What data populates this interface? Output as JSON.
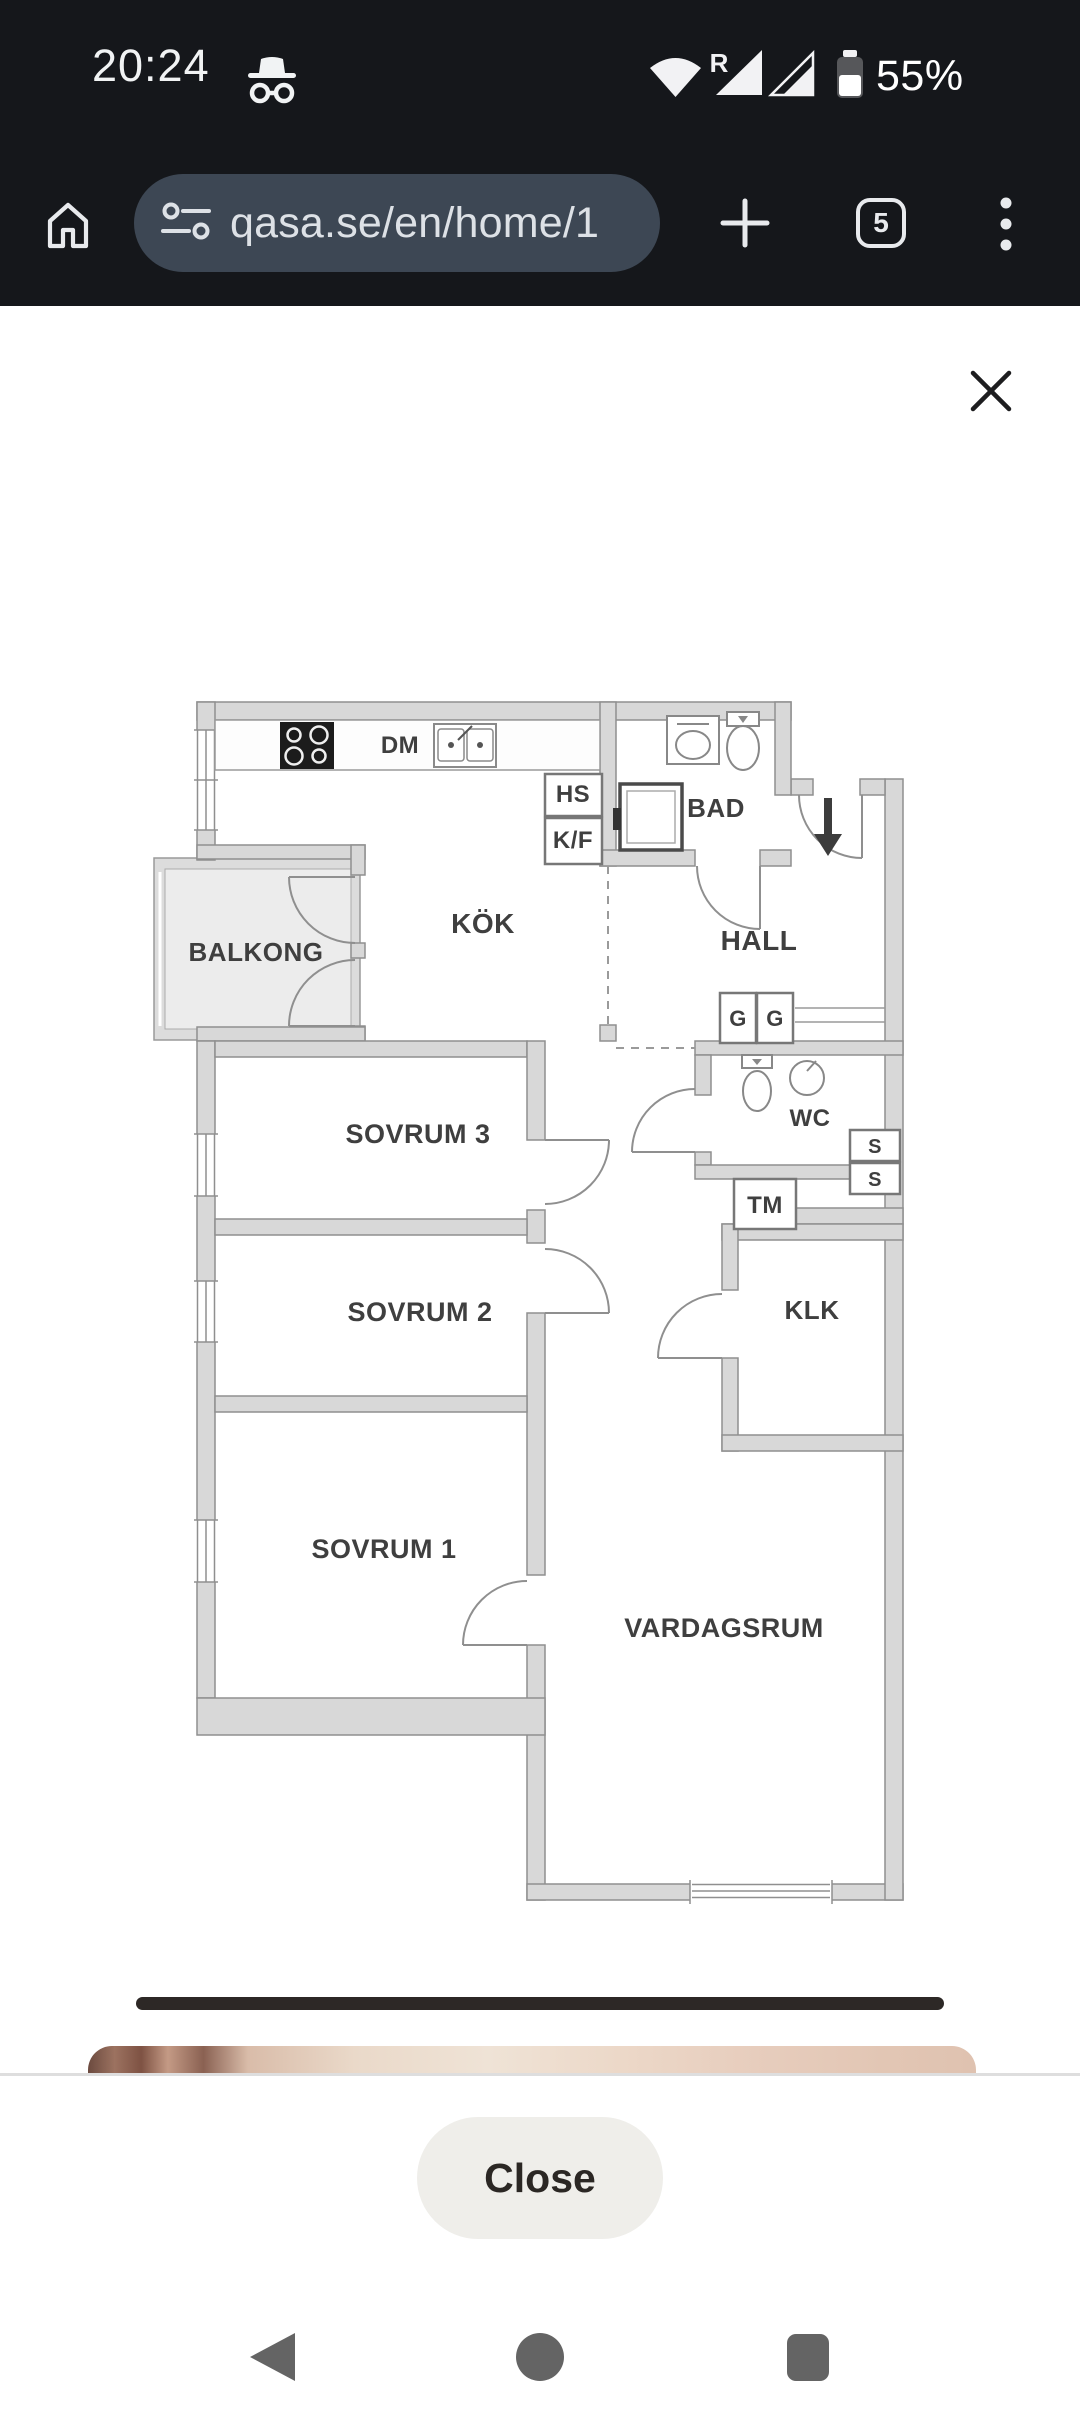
{
  "status_bar": {
    "time": "20:24",
    "incognito_icon": "incognito-icon",
    "wifi_icon": "wifi-icon",
    "network_type": "R",
    "signal_icons": [
      "cellular-signal-icon-1",
      "cellular-signal-icon-2"
    ],
    "battery_icon": "battery-icon",
    "battery_level": "55%"
  },
  "browser_bar": {
    "home_icon": "home-icon",
    "site_info_icon": "site-settings-icon",
    "url": "qasa.se/en/home/1",
    "new_tab_icon": "plus-icon",
    "tab_count": "5",
    "menu_icon": "three-dot-menu-icon"
  },
  "image_viewer": {
    "close_icon": "close-x-icon"
  },
  "floorplan": {
    "labels": [
      {
        "text": "DM",
        "x": 250,
        "y": 63,
        "size": 24
      },
      {
        "text": "HS",
        "x": 423,
        "y": 112,
        "size": 24
      },
      {
        "text": "K/F",
        "x": 423,
        "y": 158,
        "size": 24
      },
      {
        "text": "BAD",
        "x": 566,
        "y": 127,
        "size": 26
      },
      {
        "text": "KÖK",
        "x": 333,
        "y": 243,
        "size": 28
      },
      {
        "text": "HALL",
        "x": 609,
        "y": 260,
        "size": 28
      },
      {
        "text": "BALKONG",
        "x": 106,
        "y": 271,
        "size": 26
      },
      {
        "text": "G",
        "x": 588,
        "y": 336,
        "size": 22
      },
      {
        "text": "G",
        "x": 625,
        "y": 336,
        "size": 22
      },
      {
        "text": "WC",
        "x": 660,
        "y": 436,
        "size": 24
      },
      {
        "text": "SOVRUM 3",
        "x": 268,
        "y": 453,
        "size": 27
      },
      {
        "text": "S",
        "x": 725,
        "y": 463,
        "size": 20
      },
      {
        "text": "S",
        "x": 725,
        "y": 496,
        "size": 20
      },
      {
        "text": "TM",
        "x": 615,
        "y": 523,
        "size": 24
      },
      {
        "text": "SOVRUM 2",
        "x": 270,
        "y": 631,
        "size": 27
      },
      {
        "text": "KLK",
        "x": 662,
        "y": 629,
        "size": 26
      },
      {
        "text": "SOVRUM 1",
        "x": 234,
        "y": 868,
        "size": 27
      },
      {
        "text": "VARDAGSRUM",
        "x": 574,
        "y": 947,
        "size": 27
      }
    ]
  },
  "bottom_sheet": {
    "close_button": "Close"
  },
  "nav_bar": {
    "back_icon": "back-triangle-icon",
    "home_icon": "home-circle-icon",
    "recents_icon": "recents-square-icon"
  },
  "colors": {
    "chrome_bg": "#15171b",
    "url_pill_bg": "#3d4754",
    "toolbar_icon": "#e8eaed",
    "plan_wall_fill": "#d8d8d8",
    "plan_line": "#8f8f8f",
    "plan_text": "#3f3f3f",
    "close_pill_bg": "#efeeea",
    "nav_icon": "#646464"
  }
}
